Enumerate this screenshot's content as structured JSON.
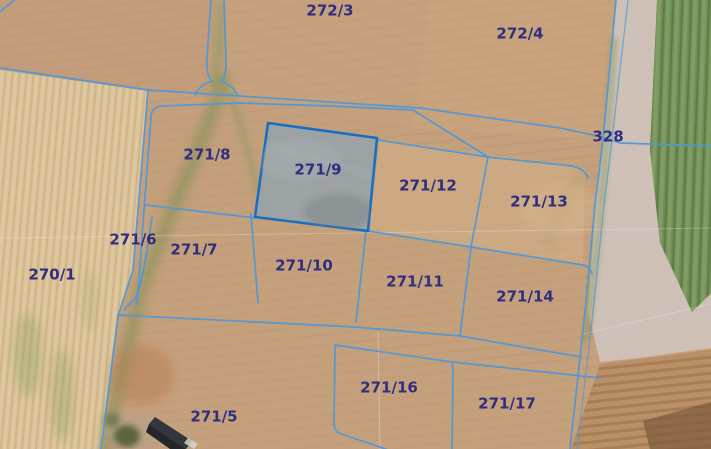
{
  "map": {
    "view_type": "cadastral-parcel-overlay-on-aerial-imagery",
    "selected_parcel_id": "271/9",
    "colors": {
      "boundary_line": "#4f97d8",
      "selected_outline": "#1a6ec2",
      "selected_fill": "#9aa2a7",
      "label_text": "#312e7e"
    },
    "parcel_labels": [
      {
        "id": "272-3",
        "text": "272/3",
        "x": 330,
        "y": 11
      },
      {
        "id": "272-4",
        "text": "272/4",
        "x": 520,
        "y": 34
      },
      {
        "id": "328",
        "text": "328",
        "x": 608,
        "y": 137
      },
      {
        "id": "271-8",
        "text": "271/8",
        "x": 207,
        "y": 155
      },
      {
        "id": "271-9",
        "text": "271/9",
        "x": 318,
        "y": 170
      },
      {
        "id": "271-12",
        "text": "271/12",
        "x": 428,
        "y": 186
      },
      {
        "id": "271-13",
        "text": "271/13",
        "x": 539,
        "y": 202
      },
      {
        "id": "271-6",
        "text": "271/6",
        "x": 133,
        "y": 240
      },
      {
        "id": "271-7",
        "text": "271/7",
        "x": 194,
        "y": 250
      },
      {
        "id": "270-1",
        "text": "270/1",
        "x": 52,
        "y": 275
      },
      {
        "id": "271-10",
        "text": "271/10",
        "x": 304,
        "y": 266
      },
      {
        "id": "271-11",
        "text": "271/11",
        "x": 415,
        "y": 282
      },
      {
        "id": "271-14",
        "text": "271/14",
        "x": 525,
        "y": 297
      },
      {
        "id": "271-16",
        "text": "271/16",
        "x": 389,
        "y": 388
      },
      {
        "id": "271-17",
        "text": "271/17",
        "x": 507,
        "y": 404
      },
      {
        "id": "271-5",
        "text": "271/5",
        "x": 214,
        "y": 417
      }
    ]
  }
}
